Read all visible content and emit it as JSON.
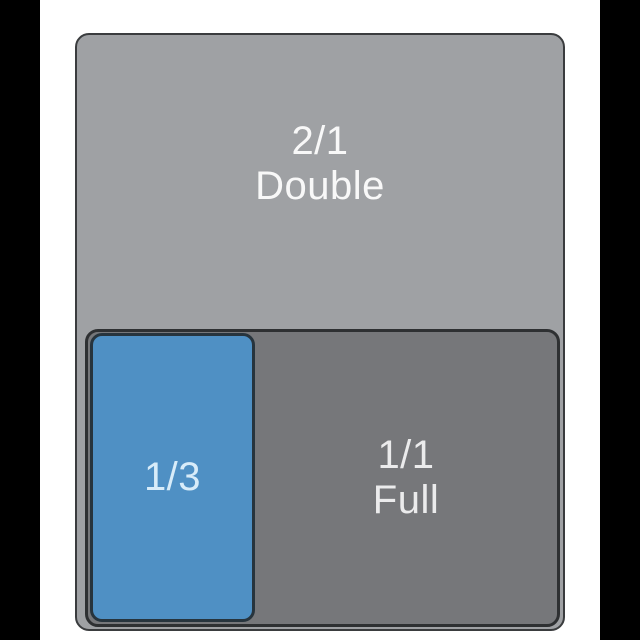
{
  "figure": {
    "background_color": "#ffffff",
    "side_bar_color": "#000000",
    "pans": {
      "double": {
        "size": "2/1",
        "name": "Double",
        "fill": "#9fa1a4",
        "border_color": "#3a3c3e",
        "text_color": "#f8f8f8"
      },
      "full": {
        "size": "1/1",
        "name": "Full",
        "fill": "#76777a",
        "border_color": "#2e3032",
        "text_color": "#ebebec"
      },
      "third": {
        "size": "1/3",
        "fill": "#4f90c4",
        "border_color": "#27343d",
        "text_color": "#d8ecf9"
      }
    }
  }
}
